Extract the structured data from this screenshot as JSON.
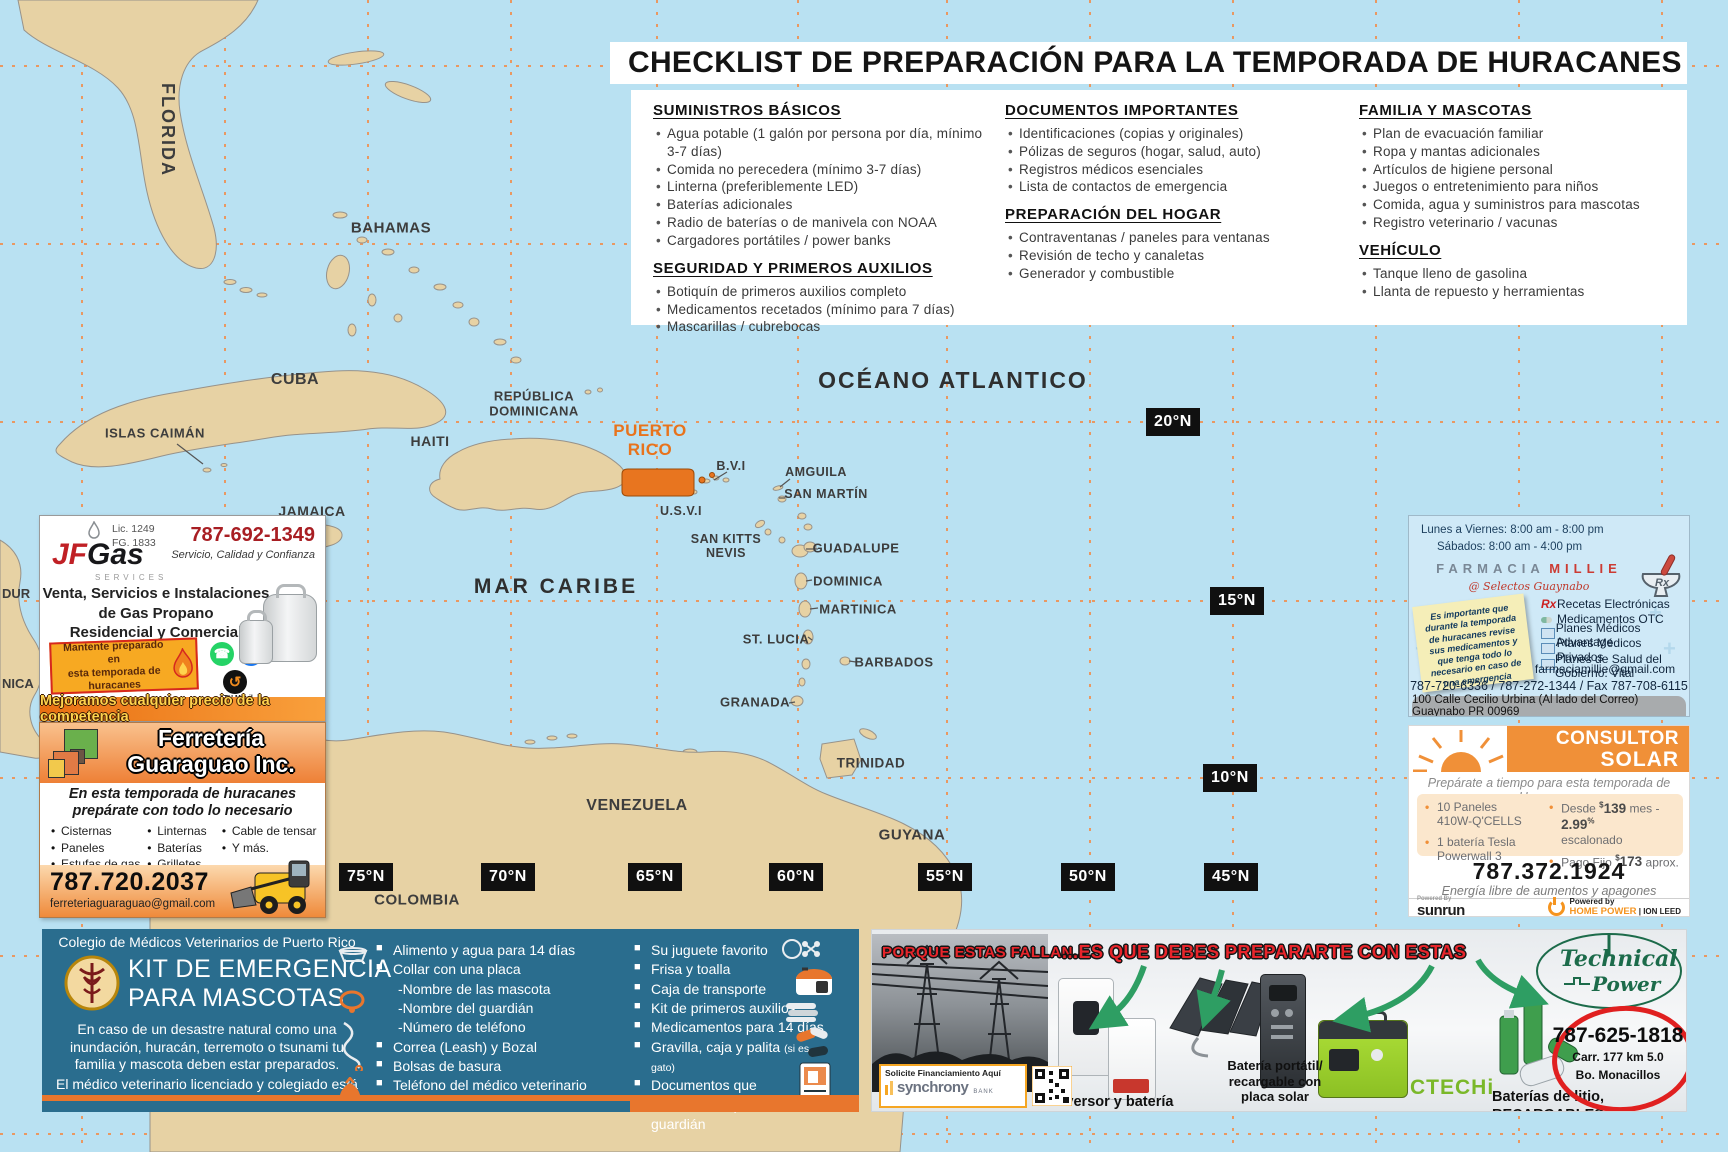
{
  "colors": {
    "water": "#b9e1f2",
    "land": "#e7d2a4",
    "grid_orange": "#f5873d",
    "puerto_rico_highlight": "#e8751f",
    "vet_teal": "#2a6d8e",
    "ad_orange": "#ef8034",
    "red_accent": "#c0392b",
    "brand_green": "#1c6b4a"
  },
  "map": {
    "ocean": "OCÉANO ATLANTICO",
    "sea": "MAR CARIBE",
    "florida": "FLORIDA",
    "bahamas": "BAHAMAS",
    "cuba": "CUBA",
    "islas_caiman": "ISLAS CAIMÁN",
    "jamaica": "JAMAICA",
    "haiti": "HAITI",
    "republica_dominicana": "REPÚBLICA\nDOMINICANA",
    "puerto_rico": "PUERTO\nRICO",
    "bvi": "B.V.I",
    "usvi": "U.S.V.I",
    "amguila": "AMGUILA",
    "san_martin": "SAN MARTÍN",
    "san_kitts": "SAN KITTS\nNEVIS",
    "guadalupe": "GUADALUPE",
    "dominica": "DOMINICA",
    "martinica": "MARTINICA",
    "st_lucia": "ST. LUCIA",
    "barbados": "BARBADOS",
    "granada": "GRANADA",
    "trinidad": "TRINIDAD",
    "venezuela": "VENEZUELA",
    "guyana": "GUYANA",
    "colombia": "COLOMBIA",
    "fragment1": "DUR",
    "fragment2": "NICA",
    "lat": [
      "20°N",
      "15°N",
      "10°N"
    ],
    "lon": [
      "75°N",
      "70°N",
      "65°N",
      "60°N",
      "55°N",
      "50°N",
      "45°N"
    ]
  },
  "checklist": {
    "title": "CHECKLIST DE PREPARACIÓN PARA LA TEMPORADA DE HURACANES",
    "col1": [
      {
        "heading": "SUMINISTROS BÁSICOS",
        "items": [
          "Agua potable (1 galón por persona por día, mínimo 3-7 días)",
          "Comida no perecedera (mínimo 3-7 días)",
          "Linterna (preferiblemente LED)",
          "Baterías adicionales",
          "Radio de baterías o de manivela con NOAA",
          "Cargadores portátiles / power banks"
        ]
      },
      {
        "heading": "SEGURIDAD Y PRIMEROS AUXILIOS",
        "items": [
          "Botiquín de primeros auxilios completo",
          "Medicamentos recetados (mínimo para 7 días)",
          "Mascarillas / cubrebocas"
        ]
      }
    ],
    "col2": [
      {
        "heading": "DOCUMENTOS IMPORTANTES",
        "items": [
          "Identificaciones (copias y originales)",
          "Pólizas de seguros (hogar, salud, auto)",
          "Registros médicos esenciales",
          "Lista de contactos de emergencia"
        ]
      },
      {
        "heading": "PREPARACIÓN DEL HOGAR",
        "items": [
          "Contraventanas / paneles para ventanas",
          "Revisión de techo y canaletas",
          "Generador y combustible"
        ]
      }
    ],
    "col3": [
      {
        "heading": "FAMILIA Y MASCOTAS",
        "items": [
          "Plan de evacuación familiar",
          "Ropa y mantas adicionales",
          "Artículos de higiene personal",
          "Juegos o entretenimiento para niños",
          "Comida, agua y suministros para mascotas",
          "Registro veterinario / vacunas"
        ]
      },
      {
        "heading": "VEHÍCULO",
        "items": [
          "Tanque lleno de gasolina",
          "Llanta de repuesto y herramientas"
        ]
      }
    ]
  },
  "jfgas": {
    "lic1": "Lic. 1249",
    "lic2": "FG. 1833",
    "brand_jf": "JF",
    "brand_gas": "Gas",
    "brand_services": "SERVICES",
    "phone": "787-692-1349",
    "tagline": "Servicio, Calidad y Confianza",
    "line1": "Venta, Servicios e Instalaciones",
    "line2": "de Gas Propano",
    "line3": "Residencial y Comercial",
    "badge": "Mantente preparado en\nesta temporada de\nhuracanes",
    "whatsapp_glyph": "☎",
    "facebook_glyph": "f",
    "ath_glyph": "↺",
    "ath": "ATH Móvil",
    "strip": "Mejoramos cualquier precio de la competencia"
  },
  "ferreteria": {
    "title1": "Ferretería",
    "title2": "Guaraguao Inc.",
    "tagline1": "En esta temporada de huracanes",
    "tagline2": "prepárate con todo lo necesario",
    "items_col1": [
      "Cisternas",
      "Paneles",
      "Estufas de gas"
    ],
    "items_col2": [
      "Linternas",
      "Baterías",
      "Grilletes"
    ],
    "items_col3": [
      "Cable de tensar",
      "Y más."
    ],
    "phone": "787.720.2037",
    "email": "ferreteriaguaraguao@gmail.com"
  },
  "farmacia": {
    "hours1": "Lunes a Viernes: 8:00 am - 8:00 pm",
    "hours2": "Sábados: 8:00 am - 4:00 pm",
    "name1": "FARMACIA",
    "name2": "MILLIE",
    "name_sub": "@ Selectos Guaynabo",
    "note": "Es importante que durante la temporada de huracanes revise sus medicamentos y que tenga todo lo necesario en caso de una emergencia",
    "services": [
      "Recetas Electrónicas",
      "Medicamentos OTC",
      "Planes Médicos Advantage",
      "Planes Médicos Privados",
      "Planes de Salud del Gobierno: Vital"
    ],
    "email": "farmaciamillie@gmail.com",
    "phones": "787-720-6336 / 787-272-1344 / Fax 787-708-6115",
    "address": "100 Calle Cecilio Urbina (Al lado del Correo) Guaynabo PR 00969"
  },
  "solar": {
    "title1": "CONSULTOR",
    "title2": "SOLAR",
    "tagline": "Prepárate a tiempo para esta temporada de Huracanes",
    "b1a": "10 Paneles",
    "b1b": "410W-Q'CELLS",
    "b2a": "1 batería Tesla",
    "b2b": "Powerwall 3",
    "b3_pre": "Desde",
    "currency": "$",
    "b3_price": "139",
    "b3_mid": "mes -",
    "b3_rate": "2.99",
    "pct": "%",
    "b3_post": "escalonado",
    "b4_pre": "Pago Fijo",
    "b4_price": "173",
    "b4_post": "aprox.",
    "phone": "787.372.1924",
    "sub": "Energía libre de aumentos y apagones",
    "powered_by_label": "Powered By",
    "sunrun": "sunrun",
    "powered_by2": "Powered by",
    "home_power": "HOME POWER",
    "ion_leed": "| ION LEED"
  },
  "vet": {
    "org": "Colegio de Médicos Veterinarios de Puerto Rico",
    "title": "KIT DE EMERGENCIA\nPARA MASCOTAS",
    "p1": "En caso de un desastre natural como una inundación, huracán, terremoto o tsunami tu familia y mascota deben estar preparados.",
    "p2": "El médico veterinario licenciado y colegiado está para ayudarte ¡Consúltalo!",
    "col1": [
      "Alimento y agua para 14 días",
      "Collar con una placa",
      "-Nombre de las mascota",
      "-Nombre del guardián",
      "-Número de teléfono",
      "Correa (Leash) y Bozal",
      "Bolsas de basura",
      "Teléfono del médico veterinario"
    ],
    "col2": [
      "Su juguete favorito",
      "Frisa y toalla",
      "Caja de transporte",
      "Kit de primeros auxilios",
      "Medicamentos para 14 días",
      "Gravilla, caja y palita",
      "Documentos que demuestren que eres el guardián"
    ],
    "cat_note": "(si es gato)"
  },
  "technical": {
    "red1": "PORQUE ESTAS FALLAN...",
    "red2": "...ES QUE DEBES PREPARARTE CON ESTAS",
    "label1": "Inversor y batería fija",
    "label2": "Batería portátil/\nrecargable con\nplaca solar",
    "ctechi": "CTECHi",
    "label3": "Baterías de litio,",
    "label3b": "RECARGABLES",
    "brand1": "Technical",
    "brand2": "Power",
    "financing": "Solicite Financiamiento Aquí",
    "bank": "synchrony",
    "bank_sub": "BANK",
    "phone": "787-625-1818",
    "addr1": "Carr. 177 km 5.0",
    "addr2": "Bo. Monacillos"
  }
}
